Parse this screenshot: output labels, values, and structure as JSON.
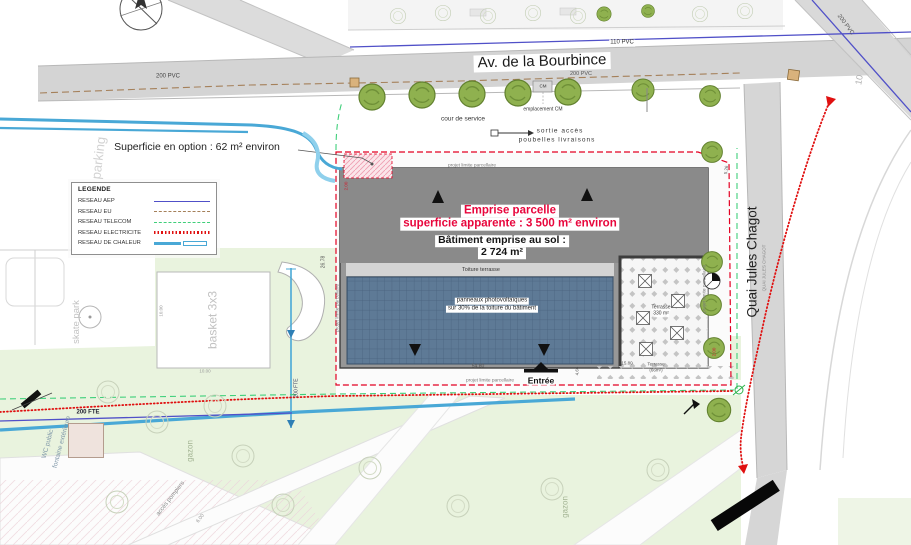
{
  "colors": {
    "parcel_red": "#e30022",
    "emprise_text_red": "#e8063c",
    "building_gray": "#8d8d8d",
    "solar_panel_blue": "#5e7a96",
    "road_gray": "#d6d6d6",
    "park_green": "#e9f3de",
    "tree_green": "#8fb14f",
    "reseau_aep": "#5050c8",
    "reseau_eu": "#a5805a",
    "reseau_telecom": "#3fcf7a",
    "reseau_electricite": "#e01010",
    "reseau_chaleur": "#49a8d6"
  },
  "streets": {
    "avenue": "Av. de la Bourbince",
    "quai": "Quai Jules Chagot",
    "quai_small": "QUAI JULES CHAGOT",
    "street_number": "10"
  },
  "legend": {
    "title": "LEGENDE",
    "items": [
      {
        "label": "RESEAU AEP",
        "type": "aep"
      },
      {
        "label": "RESEAU EU",
        "type": "eu"
      },
      {
        "label": "RESEAU TELECOM",
        "type": "telecom"
      },
      {
        "label": "RESEAU ELECTRICITE",
        "type": "electricite"
      },
      {
        "label": "RESEAU DE CHALEUR",
        "type": "chaleur"
      }
    ]
  },
  "annotations": {
    "option_area": "Superficie en option : 62 m² environ",
    "emprise_line1": "Emprise parcelle",
    "emprise_line2": "superficie apparente : 3 500 m² environ",
    "batiment_line1": "Bâtiment emprise au sol :",
    "batiment_line2": "2 724 m²",
    "toiture_terrasse": "Toiture terrasse",
    "panneaux_line1": "panneaux photovoltaïques",
    "panneaux_line2": "sur 30% de la toiture du bâtiment",
    "terrasse_word": "Terrasse",
    "terrasse_330": "330 m²",
    "terrasse_66": "(66m²)",
    "entree": "Entrée",
    "cour_de_service": "cour de service",
    "cm": "CM",
    "emplacement_cm": "emplacement CM",
    "sortie_line1": "sortie accès",
    "sortie_line2": "poubelles livraisons",
    "projet_limite": "projet limite parcellaire",
    "basket": "basket 3x3",
    "skate_park": "skate park",
    "parking": "parking",
    "gazon": "gazon",
    "wc": "WC public",
    "fontaine": "fontaine extérieure",
    "acces_pompiers": "accès pompiers"
  },
  "pipes": {
    "pvc_110": "110 PVC",
    "pvc_200": "200 PVC",
    "fte_200": "200 FTE"
  },
  "dimensions": {
    "d_2": "2.00",
    "d_26_78": "26.78",
    "d_54_80": "54.80",
    "d_4_66": "4.66",
    "d_5_26": "5.26",
    "d_15_80": "15.80",
    "d_10_00": "10.00",
    "d_6_00": "6.00"
  }
}
